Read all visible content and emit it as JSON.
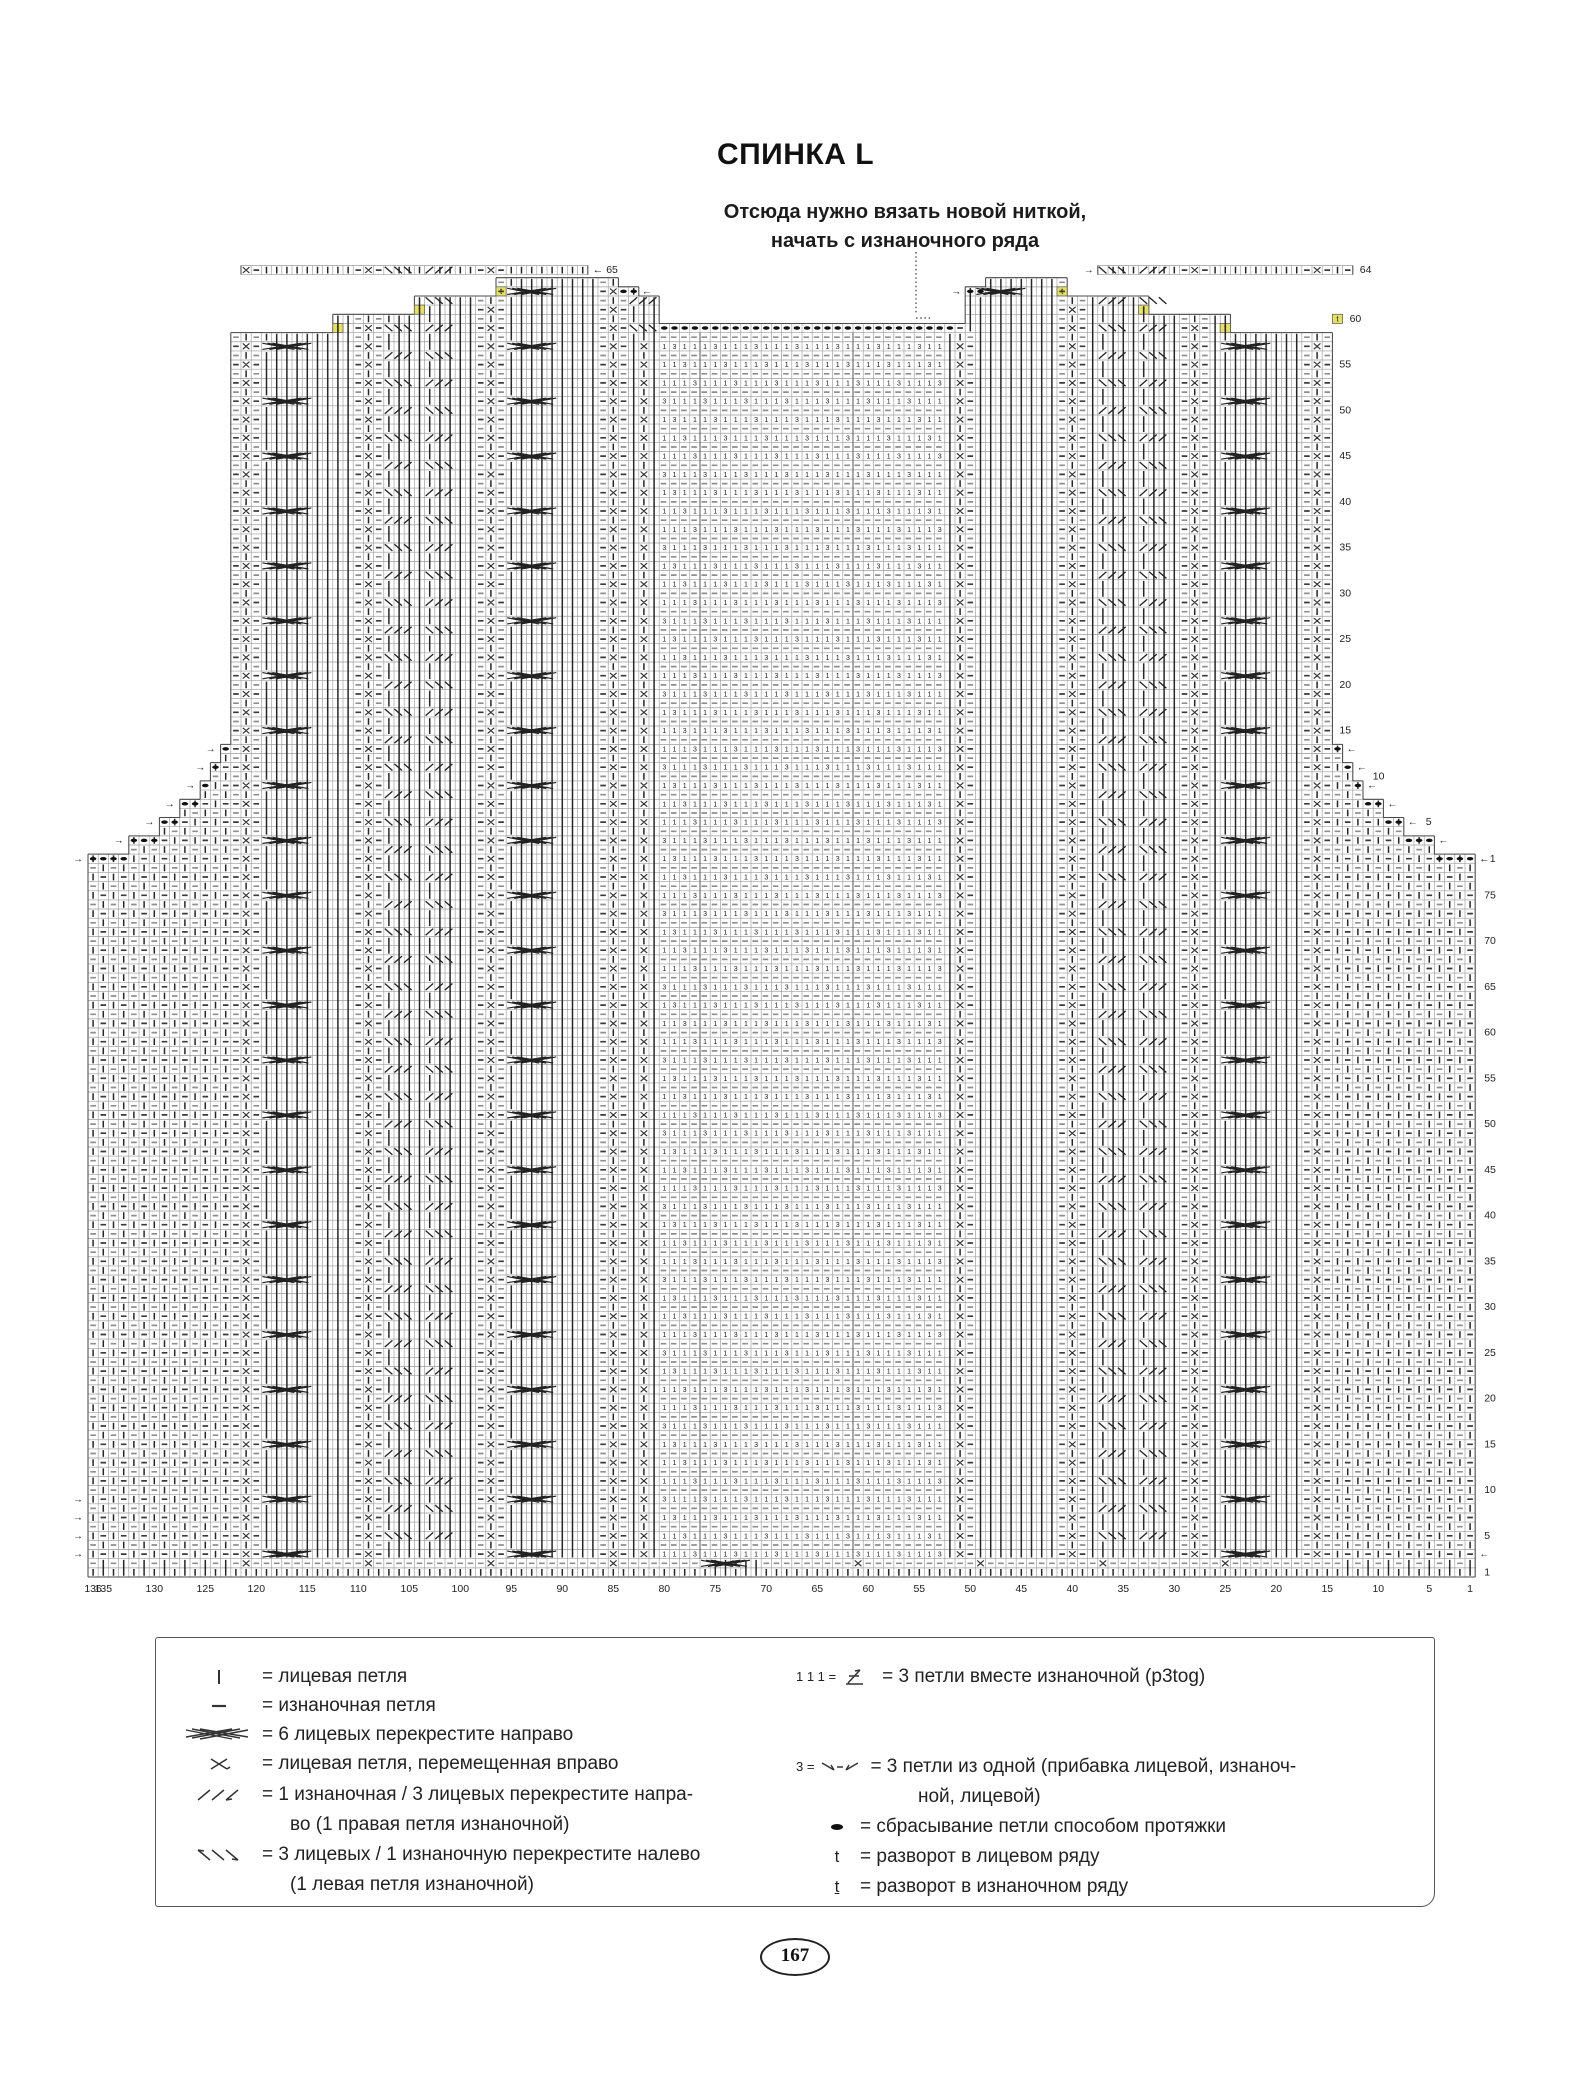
{
  "page": {
    "title": "СПИНКА L",
    "number": "167"
  },
  "annotation": {
    "line1": "Отсюда нужно вязать новой ниткой,",
    "line2": "начать с изнаночного ряда"
  },
  "chart": {
    "columns": 136,
    "lower_rows": 78,
    "upper_rows": 65,
    "bottom_labels": [
      136,
      135,
      130,
      125,
      120,
      115,
      110,
      105,
      100,
      95,
      90,
      85,
      80,
      75,
      70,
      65,
      60,
      55,
      50,
      45,
      40,
      35,
      30,
      25,
      20,
      15,
      10,
      5,
      1
    ],
    "lower_row_labels": [
      75,
      70,
      65,
      60,
      55,
      50,
      45,
      40,
      35,
      30,
      25,
      20,
      15,
      10,
      5,
      1
    ],
    "upper_row_labels": [
      15,
      20,
      25,
      30,
      35,
      40,
      45,
      50,
      55
    ],
    "upper_marks": {
      "row1": "1",
      "row5": "5",
      "row10": "10",
      "row60": "60",
      "row64": "64",
      "row65": "65"
    },
    "turn_mark": "t",
    "arrow_left": "←",
    "arrow_right": "→",
    "panel_digit_main": "1",
    "panel_digit_inc": "3"
  },
  "colors": {
    "symbol": "#2f2f2f",
    "gray_dash": "#8f8f8f",
    "grid": "#9d9d9d",
    "grid_dark": "#4a4a4a",
    "highlight": "#e7e15e",
    "dot": "#111111"
  },
  "legend": {
    "left": [
      {
        "name": "knit-stitch",
        "label": "= лицевая петля"
      },
      {
        "name": "purl-stitch",
        "label": "= изнаночная петля"
      },
      {
        "name": "cable-6-right",
        "label": "= 6 лицевых перекрестите направо"
      },
      {
        "name": "knit-moved-right",
        "label": "= лицевая петля, перемещенная вправо"
      },
      {
        "name": "cross-3-right",
        "label": "= 1 изнаночная / 3 лицевых перекрестите напра-",
        "label2": "во (1 правая петля изнаночной)"
      },
      {
        "name": "cross-3-left",
        "label": "= 3 лицевых / 1 изнаночную перекрестите налево",
        "label2": "(1 левая петля изнаночной)"
      }
    ],
    "right": [
      {
        "name": "p3tog",
        "prefix": "1 1 1 =",
        "label": "= 3 петли вместе изнаночной (p3tog)"
      },
      {
        "name": "make-3-from-1",
        "prefix": "3 =",
        "label": "= 3 петли из одной (прибавка лицевой, изнаноч-",
        "label2": "ной, лицевой)"
      },
      {
        "name": "drop-stitch",
        "label": "= сбрасывание петли способом протяжки"
      },
      {
        "name": "turn-right-side",
        "symbol": "t",
        "label": "= разворот в лицевом ряду"
      },
      {
        "name": "turn-wrong-side",
        "symbol": "t",
        "underline": true,
        "label": "= разворот в изнаночном ряду"
      }
    ]
  }
}
